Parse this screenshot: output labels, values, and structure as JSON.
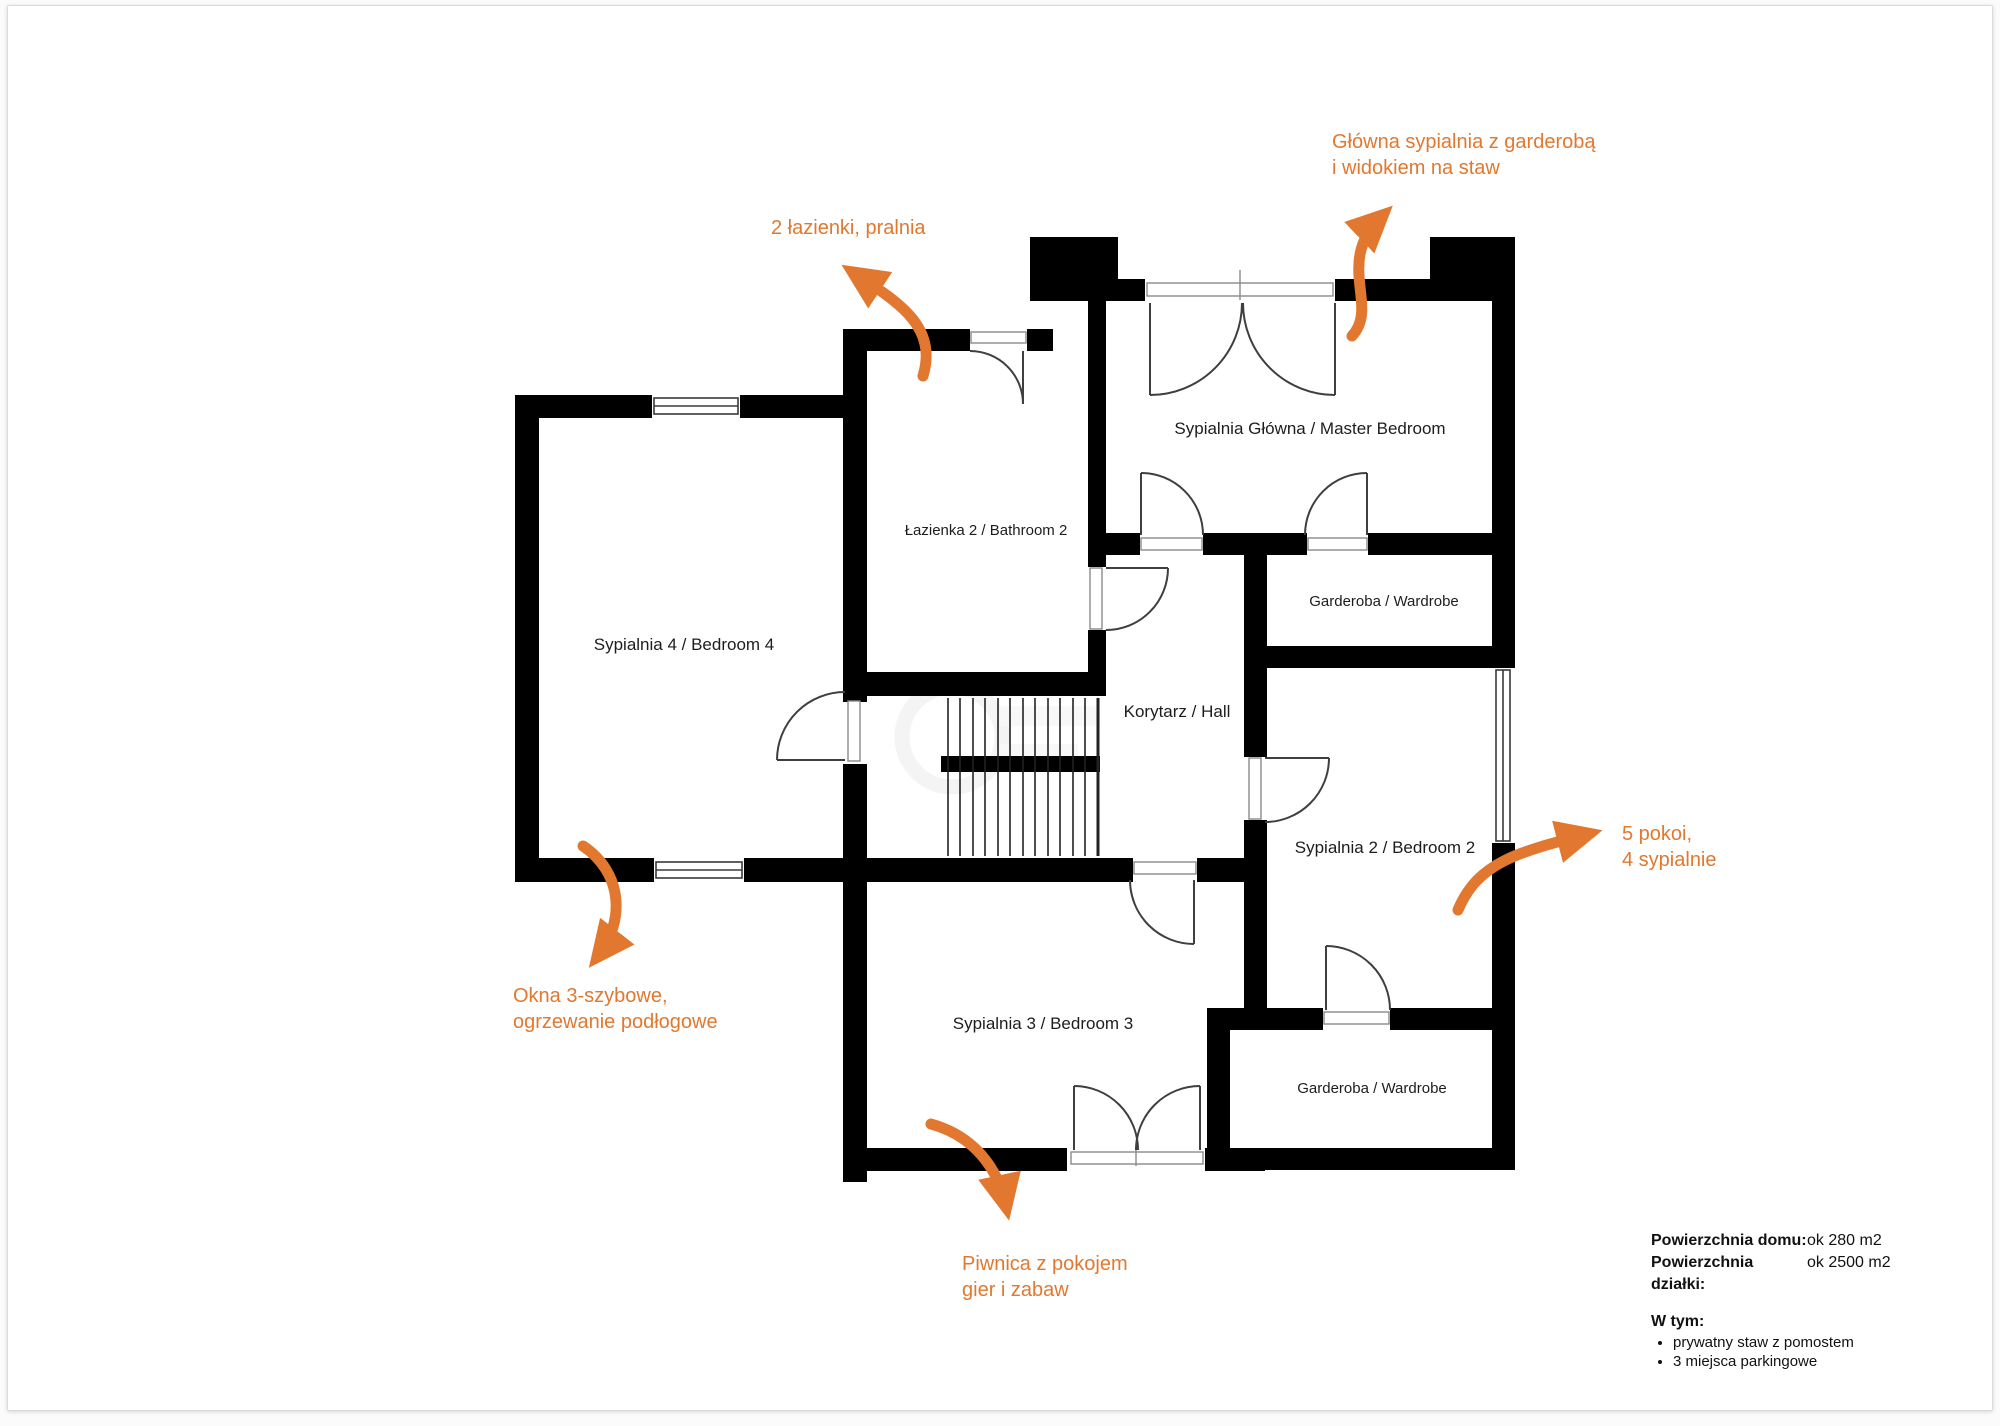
{
  "colors": {
    "accent_orange": "#E2782F",
    "wall_black": "#000000"
  },
  "rooms": [
    {
      "label": "Sypialnia 4 / Bedroom 4"
    },
    {
      "label": "Łazienka 2 / Bathroom 2"
    },
    {
      "label": "Sypialnia Główna / Master Bedroom"
    },
    {
      "label": "Garderoba / Wardrobe"
    },
    {
      "label": "Korytarz / Hall"
    },
    {
      "label": "Sypialnia 2 / Bedroom 2"
    },
    {
      "label": "Sypialnia 3 / Bedroom 3"
    },
    {
      "label": "Garderoba / Wardrobe"
    }
  ],
  "annotations": [
    {
      "lines": [
        "Główna sypialnia z garderobą",
        "i widokiem na staw"
      ]
    },
    {
      "lines": [
        "2 łazienki, pralnia"
      ]
    },
    {
      "lines": [
        "5 pokoi,",
        "4 sypialnie"
      ]
    },
    {
      "lines": [
        "Okna 3-szybowe,",
        "ogrzewanie podłogowe"
      ]
    },
    {
      "lines": [
        "Piwnica z pokojem",
        "gier i zabaw"
      ]
    }
  ],
  "info": {
    "rows": [
      {
        "label": "Powierzchnia domu:",
        "value": "ok 280 m2"
      },
      {
        "label": "Powierzchnia działki:",
        "value": "ok 2500 m2"
      }
    ],
    "subheading": "W tym:",
    "bullets": [
      "prywatny staw z pomostem",
      "3 miejsca parkingowe"
    ]
  }
}
